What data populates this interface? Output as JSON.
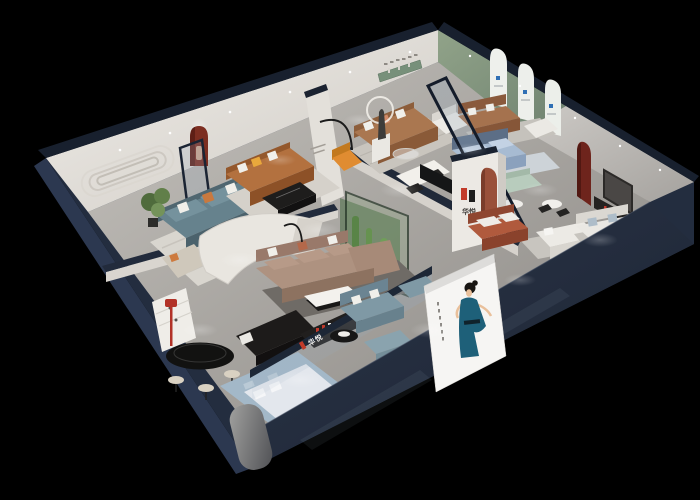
{
  "scene": {
    "description": "3D isometric cutaway render of a furniture showroom interior at night on a black background",
    "background_color": "#000000"
  },
  "brand": {
    "name": "华悦",
    "logo_mark": "H-monogram, left half red / right half black"
  },
  "logo_wall": {
    "sign_text": "华悦"
  },
  "storefront": {
    "glass_sign_text": "华悦"
  },
  "poster": {
    "subject": "woman in teal halter dress, black updo hair, white background",
    "background": "#f6f5f3",
    "dress_color": "#1e6079"
  },
  "palette": {
    "outer_wall_navy": "#232d3f",
    "wall_cap_navy": "#18202e",
    "floor_gray": "#a5a29d",
    "interior_wall_cream": "#ece9e4",
    "green_arch_wall": "#8a9c82",
    "red_niche": "#7c2e21",
    "sofa_teal": "#66828d",
    "sofa_caramel": "#b3713f",
    "sofa_tan": "#aa7750",
    "sofa_taupe": "#ae9280",
    "sofa_rust": "#b05a3d",
    "front_sofa_teal": "#7f99a5",
    "bed_blue": "#a7bbd2",
    "mint_chair": "#bccfc3",
    "accent_orange": "#e08c31",
    "accent_yellow": "#e9a83c",
    "brand_red": "#c23b2a",
    "plant_green": "#4f6b3c",
    "terrarium_glass": "rgba(130,170,120,0.22)",
    "arch_panel_logo_blue": "#2f6fb4"
  }
}
